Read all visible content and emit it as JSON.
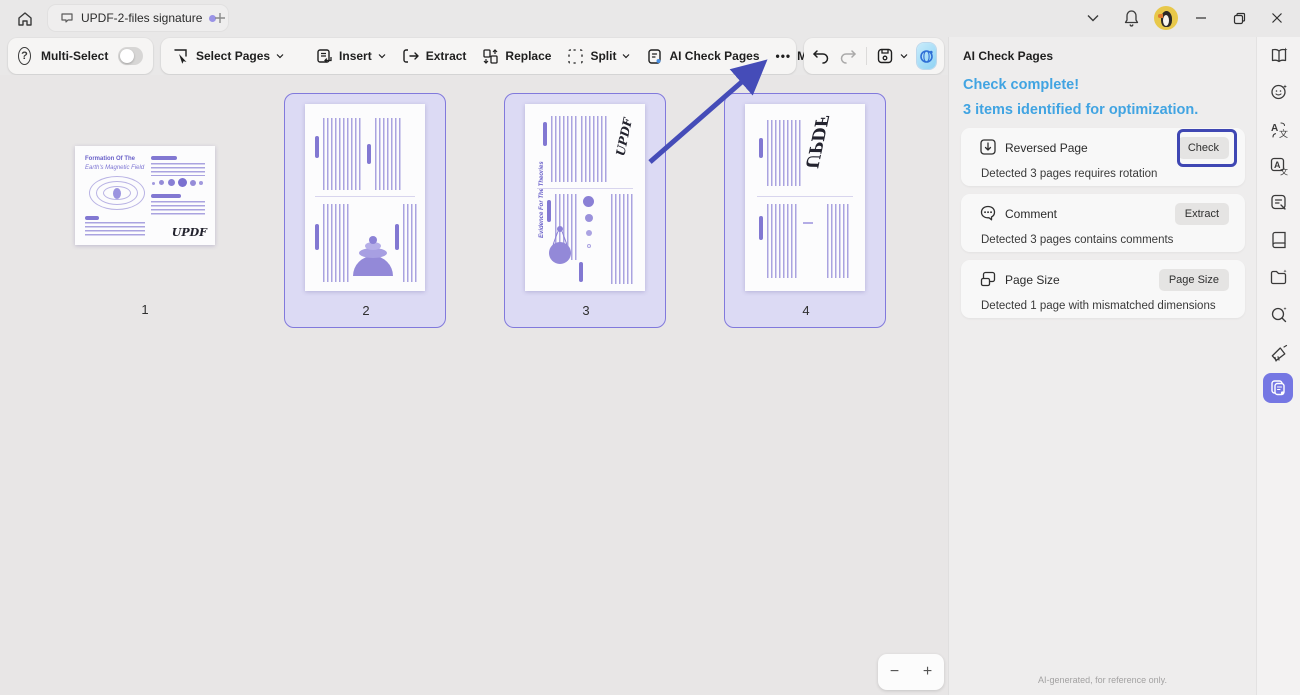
{
  "titlebar": {
    "tab_title": "UPDF-2-files signature",
    "icons": [
      "home-icon",
      "document-tab-icon",
      "new-tab-icon",
      "dropdown-chevron-icon",
      "bell-icon",
      "avatar",
      "minimize-icon",
      "restore-icon",
      "close-icon"
    ]
  },
  "glyphs": {
    "help": "?",
    "more_dots": "•••",
    "zoom_out": "−",
    "zoom_in": "+"
  },
  "toolbar": {
    "multi_select_label": "Multi-Select",
    "select_pages_label": "Select Pages",
    "insert_label": "Insert",
    "extract_label": "Extract",
    "replace_label": "Replace",
    "split_label": "Split",
    "ai_check_pages_label": "AI Check Pages",
    "more_label": "More",
    "icons": [
      "help-icon",
      "select-pages-icon",
      "insert-icon",
      "extract-icon",
      "replace-icon",
      "split-icon",
      "ai-check-pages-icon",
      "rotate-left-icon",
      "undo-icon",
      "redo-icon",
      "save-icon",
      "save-chevron-icon",
      "ai-assistant-icon"
    ]
  },
  "canvas": {
    "pages": [
      {
        "number": "1",
        "selected": false
      },
      {
        "number": "2",
        "selected": true
      },
      {
        "number": "3",
        "selected": true
      },
      {
        "number": "4",
        "selected": true
      }
    ],
    "page1": {
      "title_line1": "Formation Of The",
      "title_line2": "Earth's Magnetic Field",
      "signature": "UPDF"
    },
    "page3": {
      "side_title": "Evidence For The Theories",
      "signature": "UPDF"
    },
    "page4": {
      "signature": "UPDF"
    }
  },
  "panel": {
    "title": "AI Check Pages",
    "status_line1": "Check complete!",
    "status_line2": "3 items identified for optimization.",
    "items": [
      {
        "icon": "reversed-page-icon",
        "title": "Reversed Page",
        "button": "Check",
        "detail": "Detected 3 pages requires rotation",
        "highlighted": true
      },
      {
        "icon": "comment-icon",
        "title": "Comment",
        "button": "Extract",
        "detail": "Detected 3 pages contains comments",
        "highlighted": false
      },
      {
        "icon": "page-size-icon",
        "title": "Page Size",
        "button": "Page Size",
        "detail": "Detected 1 page with mismatched dimensions",
        "highlighted": false
      }
    ],
    "footer": "AI-generated, for reference only."
  },
  "ribbon": {
    "tools": [
      "ai-reader-icon",
      "ai-chat-icon",
      "translate-icon",
      "translate-box-icon",
      "ai-note-icon",
      "book-icon",
      "ai-folder-icon",
      "ai-search-icon",
      "announce-icon",
      "ai-check-pages-active-icon"
    ]
  },
  "colors": {
    "accent_purple": "#3f47b3",
    "accent_blue": "#41a4e2",
    "selection_fill": "#dcdaf4",
    "selection_border": "#8179dc",
    "active_tool_bg": "#7577e3"
  }
}
